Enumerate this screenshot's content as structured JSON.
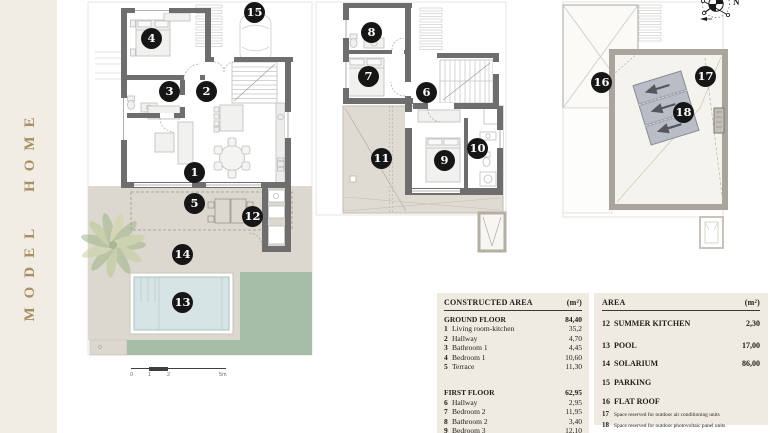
{
  "brand": {
    "vertical_title": "MODEL HOME"
  },
  "markers": [
    {
      "num": "1"
    },
    {
      "num": "2"
    },
    {
      "num": "3"
    },
    {
      "num": "4"
    },
    {
      "num": "5"
    },
    {
      "num": "6"
    },
    {
      "num": "7"
    },
    {
      "num": "8"
    },
    {
      "num": "9"
    },
    {
      "num": "10"
    },
    {
      "num": "11"
    },
    {
      "num": "12"
    },
    {
      "num": "13"
    },
    {
      "num": "14"
    },
    {
      "num": "15"
    },
    {
      "num": "16"
    },
    {
      "num": "17"
    },
    {
      "num": "18"
    }
  ],
  "scale_bar": {
    "t0": "0",
    "t1": "1",
    "t2": "2",
    "t3": "5m"
  },
  "compass": {
    "north_label": "N"
  },
  "legend_left": {
    "title": "CONSTRUCTED AREA",
    "unit": "(m²)",
    "sections": [
      {
        "title": "GROUND FLOOR",
        "total": "84,40",
        "rows": [
          {
            "num": "1",
            "label": "Living room-kitchen",
            "value": "35,2"
          },
          {
            "num": "2",
            "label": "Hallway",
            "value": "4,70"
          },
          {
            "num": "3",
            "label": "Bathroom 1",
            "value": "4,45"
          },
          {
            "num": "4",
            "label": "Bedroom 1",
            "value": "10,60"
          },
          {
            "num": "5",
            "label": "Terrace",
            "value": "11,30"
          }
        ]
      },
      {
        "title": "FIRST FLOOR",
        "total": "62,95",
        "rows": [
          {
            "num": "6",
            "label": "Hallway",
            "value": "2,95"
          },
          {
            "num": "7",
            "label": "Bedroom 2",
            "value": "11,95"
          },
          {
            "num": "8",
            "label": "Bathroom 2",
            "value": "3,40"
          },
          {
            "num": "9",
            "label": "Bedroom 3",
            "value": "12,10"
          }
        ]
      }
    ]
  },
  "legend_right": {
    "title": "AREA",
    "unit": "(m²)",
    "rows": [
      {
        "num": "12",
        "label": "SUMMER KITCHEN",
        "value": "2,30"
      },
      {
        "num": "13",
        "label": "POOL",
        "value": "17,00"
      },
      {
        "num": "14",
        "label": "SOLARIUM",
        "value": "86,00"
      },
      {
        "num": "15",
        "label": "PARKING",
        "value": ""
      },
      {
        "num": "16",
        "label": "FLAT ROOF",
        "value": ""
      }
    ],
    "notes": [
      {
        "num": "17",
        "label": "Space reserved for outdoor air conditioning units"
      },
      {
        "num": "18",
        "label": "Space reserved for outdoor photovoltaic panel units"
      }
    ]
  },
  "colors": {
    "band_cream": "#f2ede4",
    "brand_gold": "#a88f63",
    "wall_gray": "#6e6e6e",
    "roof_wall_beige": "#a9a49c",
    "terrace_beige": "#ddd8cf",
    "lawn_green": "#a6bea7",
    "pool_blue": "#d6e4e5",
    "panel_gray": "#b9bdc6",
    "legend_bg": "#f0ebe2",
    "marker_black": "#161616"
  }
}
